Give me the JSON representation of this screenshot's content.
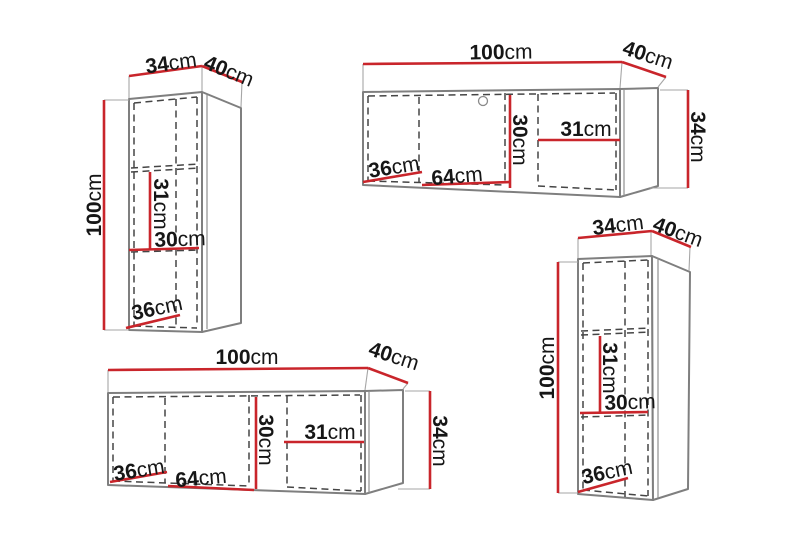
{
  "diagram": {
    "kind": "furniture-dimension-diagram",
    "colors": {
      "dimension_line": "#c9252b",
      "cabinet_outline": "#7f7f7f",
      "panel_dashed": "#454545",
      "label": "#161616",
      "background": "#ffffff"
    }
  },
  "units": [
    {
      "name": "tall-wall-cabinet-top-left",
      "dims": {
        "width": {
          "v": "34",
          "u": "cm"
        },
        "depth": {
          "v": "40",
          "u": "cm"
        },
        "height": {
          "v": "100",
          "u": "cm"
        },
        "inner_height": {
          "v": "31",
          "u": "cm"
        },
        "inner_width": {
          "v": "30",
          "u": "cm"
        },
        "inner_depth": {
          "v": "36",
          "u": "cm"
        }
      }
    },
    {
      "name": "wide-wall-cabinet-top-right",
      "dims": {
        "width": {
          "v": "100",
          "u": "cm"
        },
        "depth": {
          "v": "40",
          "u": "cm"
        },
        "height": {
          "v": "34",
          "u": "cm"
        },
        "inner_height": {
          "v": "30",
          "u": "cm"
        },
        "inner_width_right": {
          "v": "31",
          "u": "cm"
        },
        "inner_depth": {
          "v": "36",
          "u": "cm"
        },
        "inner_width_left": {
          "v": "64",
          "u": "cm"
        }
      }
    },
    {
      "name": "wide-wall-cabinet-bottom-left",
      "dims": {
        "width": {
          "v": "100",
          "u": "cm"
        },
        "depth": {
          "v": "40",
          "u": "cm"
        },
        "height": {
          "v": "34",
          "u": "cm"
        },
        "inner_height": {
          "v": "30",
          "u": "cm"
        },
        "inner_width_right": {
          "v": "31",
          "u": "cm"
        },
        "inner_depth": {
          "v": "36",
          "u": "cm"
        },
        "inner_width_left": {
          "v": "64",
          "u": "cm"
        }
      }
    },
    {
      "name": "tall-wall-cabinet-bottom-right",
      "dims": {
        "width": {
          "v": "34",
          "u": "cm"
        },
        "depth": {
          "v": "40",
          "u": "cm"
        },
        "height": {
          "v": "100",
          "u": "cm"
        },
        "inner_height": {
          "v": "31",
          "u": "cm"
        },
        "inner_width": {
          "v": "30",
          "u": "cm"
        },
        "inner_depth": {
          "v": "36",
          "u": "cm"
        }
      }
    }
  ]
}
